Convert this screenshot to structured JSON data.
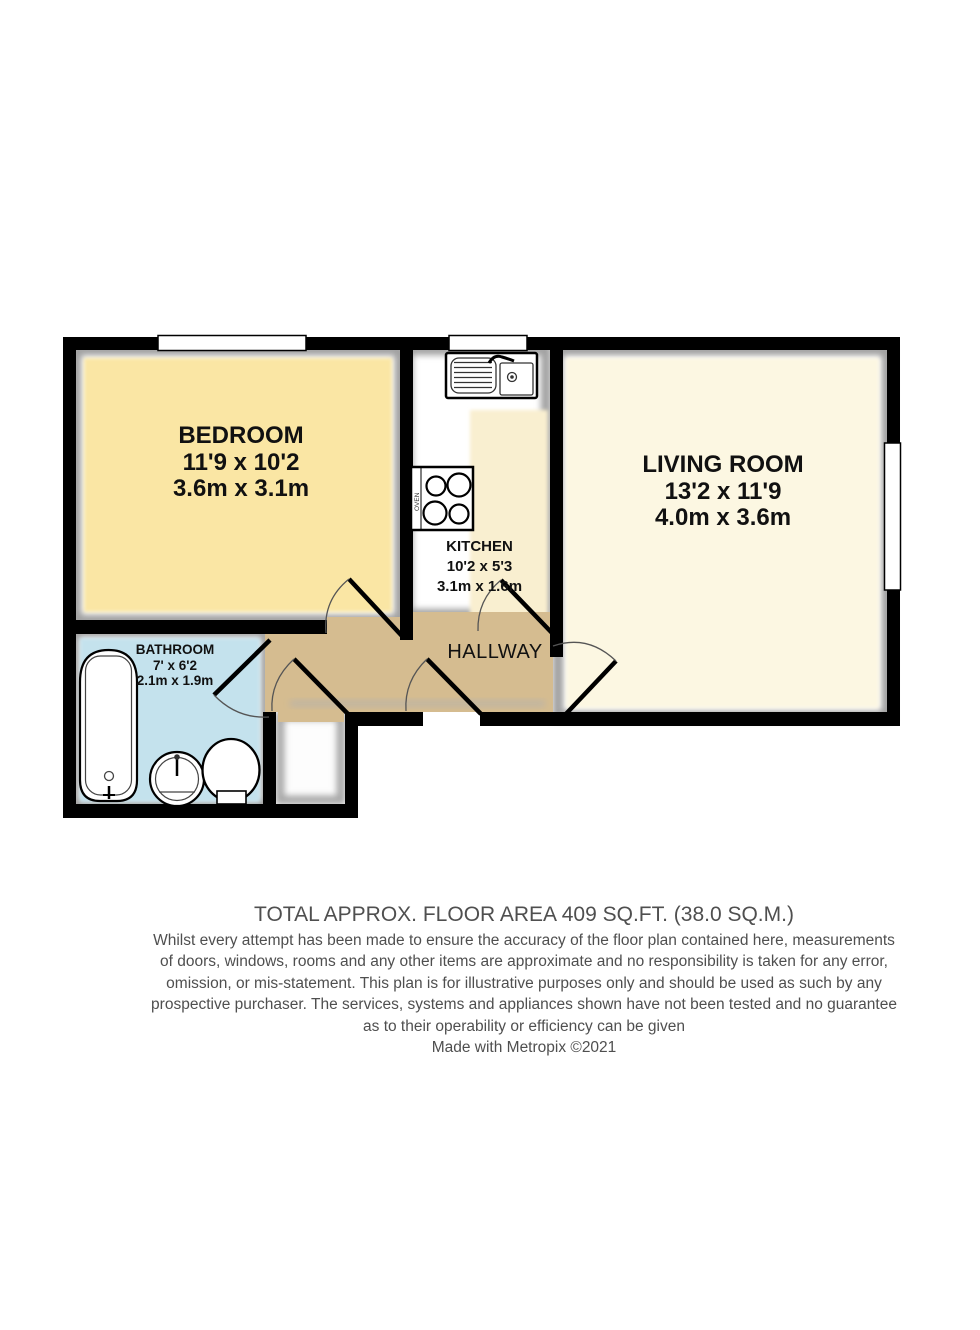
{
  "plan": {
    "rooms": {
      "bedroom": {
        "name": "BEDROOM",
        "imperial": "11'9 x 10'2",
        "metric": "3.6m x 3.1m",
        "fill": "#fae6a4"
      },
      "kitchen": {
        "name": "KITCHEN",
        "imperial": "10'2 x 5'3",
        "metric": "3.1m x 1.6m",
        "fill": "#f9efd0"
      },
      "living_room": {
        "name": "LIVING ROOM",
        "imperial": "13'2 x 11'9",
        "metric": "4.0m x 3.6m",
        "fill": "#fcf7e2"
      },
      "bathroom": {
        "name": "BATHROOM",
        "imperial": "7' x 6'2",
        "metric": "2.1m x 1.9m",
        "fill": "#c4e2ed"
      },
      "hallway": {
        "name": "HALLWAY",
        "fill": "#d5bc90"
      }
    },
    "hob_label": "OVEN",
    "colors": {
      "wall": "#000000",
      "shadow": "#a0a0a0",
      "window": "#ffffff",
      "fixture_stroke": "#000000"
    }
  },
  "footer": {
    "area_title": "TOTAL APPROX. FLOOR AREA 409 SQ.FT. (38.0 SQ.M.)",
    "disclaimer_lines": [
      "Whilst every attempt has been made to ensure the accuracy of the floor plan contained here, measurements",
      "of doors, windows, rooms and any other items are approximate and no responsibility is taken for any error,",
      "omission, or mis-statement. This plan is for illustrative purposes only and should be used as such by any",
      "prospective purchaser. The services, systems and appliances shown have not been tested and no guarantee",
      "as to their operability or efficiency can be given"
    ],
    "credit": "Made with Metropix ©2021"
  }
}
